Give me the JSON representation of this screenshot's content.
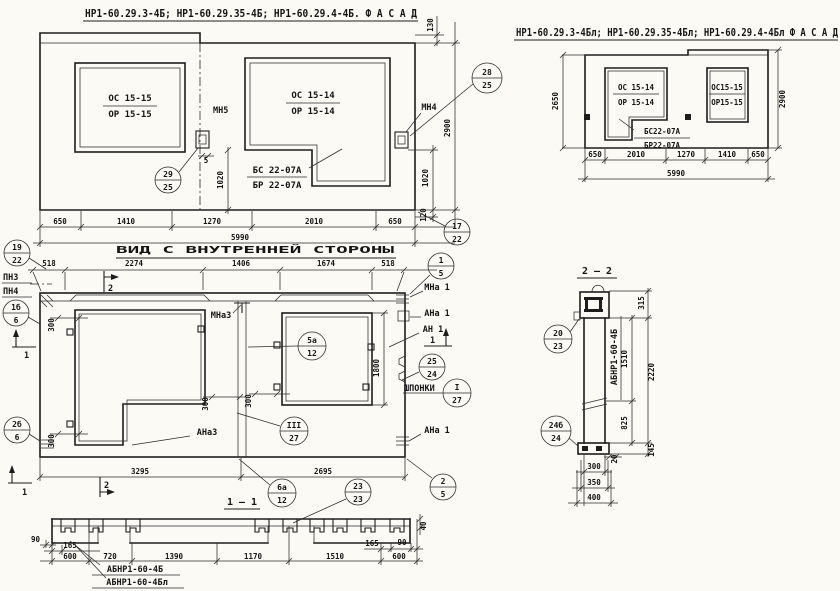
{
  "sheet": {
    "bg": "#fbfaf5",
    "ink": "#1d1d1d"
  },
  "facade_left": {
    "title": "НР1-60.29.3-4Б; НР1-60.29.35-4Б; НР1-60.29.4-4Б.  Ф А С А Д",
    "win1_top": "ОС 15-15",
    "win1_bot": "ОР 15-15",
    "win2_top": "ОС 15-14",
    "win2_bot": "ОР 15-14",
    "door_top": "БС 22-07А",
    "door_bot": "БР 22-07А",
    "anchor_mid": "МН5",
    "anchor_right": "МН4",
    "dims": {
      "bottom": [
        "650",
        "1410",
        "1270",
        "2010",
        "650"
      ],
      "total": "5990",
      "d130": "130",
      "d2900": "2900",
      "d1020": "1020",
      "d120": "120",
      "d5": "5"
    },
    "callouts": {
      "c29": {
        "top": "29",
        "bot": "25"
      },
      "c28": {
        "top": "28",
        "bot": "25"
      },
      "c17": {
        "top": "17",
        "bot": "22"
      }
    }
  },
  "facade_right": {
    "title": "НР1-60.29.3-4Бл; НР1-60.29.35-4Бл; НР1-60.29.4-4Бл  Ф А С А Д",
    "win1_top": "ОС 15-14",
    "win1_bot": "ОР 15-14",
    "door_top": "БС22-07А",
    "door_bot": "БР22-07А",
    "win2_top": "ОС15-15",
    "win2_bot": "ОР15-15",
    "dims": {
      "left": "2650",
      "right": "2900",
      "bottom": [
        "650",
        "2010",
        "1270",
        "1410",
        "650"
      ],
      "total": "5990"
    }
  },
  "inner_view": {
    "title": "ВИД С ВНУТРЕННЕЙ СТОРОНЫ",
    "axis_top": "ПН3",
    "axis_bot": "ПН4",
    "lbl_mna3": "МНа3",
    "lbl_mna1": "МНа 1",
    "lbl_ana1": "АНа 1",
    "lbl_an1": "АН 1",
    "lbl_ana1b": "АНа 1",
    "lbl_ana3": "АНа3",
    "lbl_shponki": "ШПОНКИ",
    "sec1": "1",
    "sec2": "2",
    "dims": {
      "top": [
        "518",
        "2274",
        "1406",
        "1674",
        "518"
      ],
      "d300": "300",
      "d1800": "1800",
      "d3295": "3295",
      "d2695": "2695"
    },
    "callouts": {
      "c19": {
        "top": "19",
        "bot": "22"
      },
      "c1b": {
        "top": "1б",
        "bot": "6"
      },
      "c2b": {
        "top": "2б",
        "bot": "6"
      },
      "c1_5": {
        "top": "1",
        "bot": "5"
      },
      "c25": {
        "top": "25",
        "bot": "24"
      },
      "cI": {
        "top": "I",
        "bot": "27"
      },
      "cIII": {
        "top": "III",
        "bot": "27"
      },
      "c5a": {
        "top": "5а",
        "bot": "12"
      },
      "c6a": {
        "top": "6а",
        "bot": "12"
      },
      "c2_5": {
        "top": "2",
        "bot": "5"
      }
    }
  },
  "section_1": {
    "title": "1 – 1",
    "mark_b": "АБНР1-60-4Б",
    "mark_bl": "АБНР1-60-4Бл",
    "dims": {
      "d90l": "90",
      "d165l": "165",
      "d600l": "600",
      "d720": "720",
      "d1390": "1390",
      "d1170": "1170",
      "d1510": "1510",
      "d165r": "165",
      "d90r": "90",
      "d600r": "600",
      "d40": "40"
    },
    "callouts": {
      "c23": {
        "top": "23",
        "bot": "23"
      }
    }
  },
  "section_2": {
    "title": "2 – 2",
    "mark_vert": "АБНР1-60-4Б",
    "dims": {
      "d315": "315",
      "d1510": "1510",
      "d2220": "2220",
      "d825": "825",
      "d145": "145",
      "d20": "20",
      "d300": "300",
      "d350": "350",
      "d400": "400"
    },
    "callouts": {
      "c20": {
        "top": "20",
        "bot": "23"
      },
      "c24b": {
        "top": "24б",
        "bot": "24"
      }
    }
  }
}
